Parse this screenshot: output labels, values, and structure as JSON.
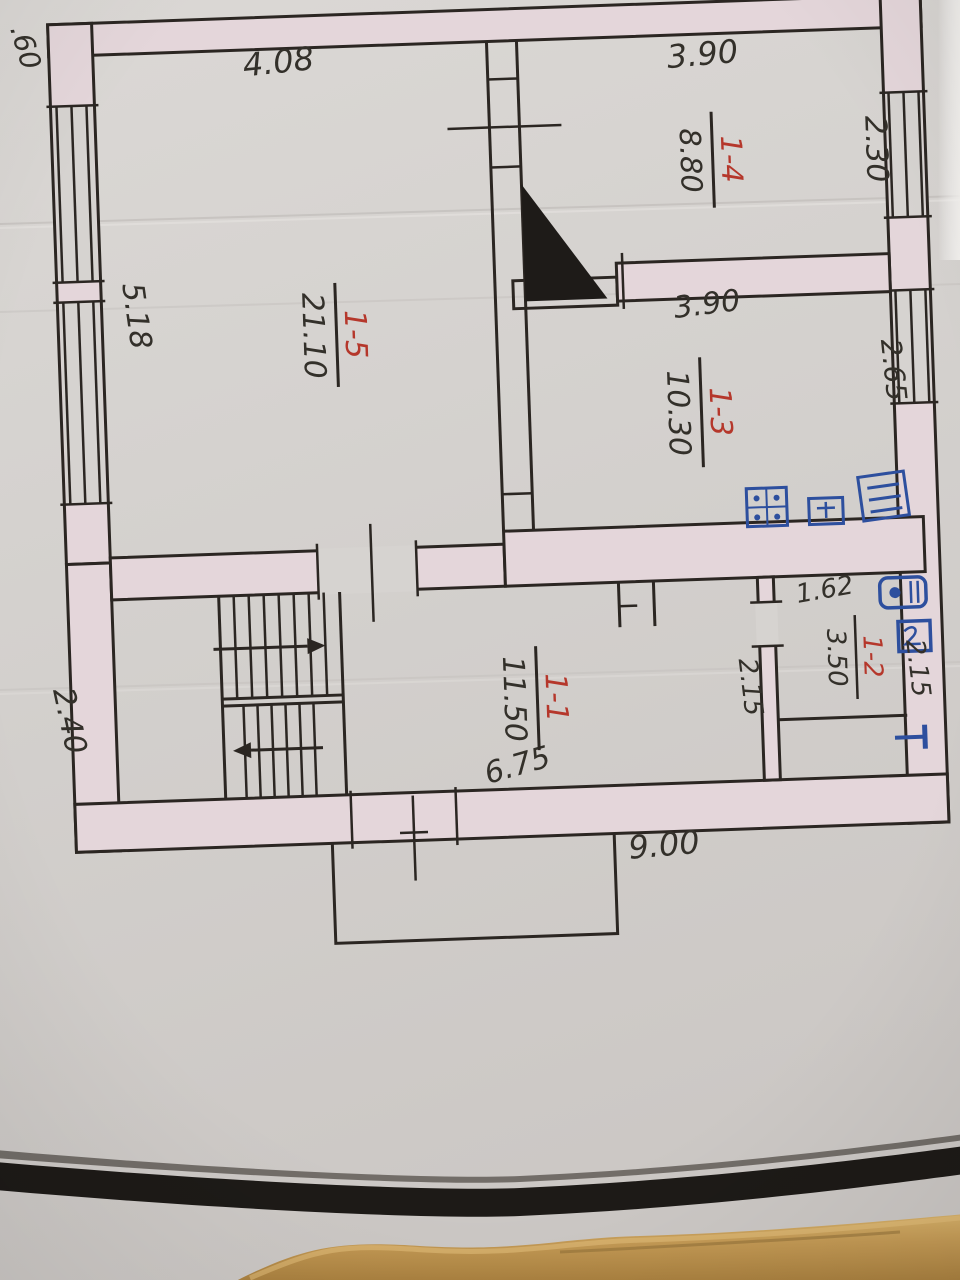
{
  "photo": {
    "paper_color": "#d6d3d0",
    "cardboard_color": "#c49a55",
    "band_color": "#1d1a17"
  },
  "plan": {
    "rooms": [
      {
        "number": "1-5",
        "area": "21.10"
      },
      {
        "number": "1-4",
        "area": "8.80"
      },
      {
        "number": "1-3",
        "area": "10.30"
      },
      {
        "number": "1-2",
        "area": "3.50"
      },
      {
        "number": "1-1",
        "area": "11.50"
      }
    ],
    "dimensions": {
      "corner_top_left": ".60",
      "top_left_width": "4.08",
      "top_right_width": "3.90",
      "right_upper": "2.30",
      "left_upper": "5.18",
      "kitchen_top_width": "3.90",
      "right_kitchen": "2.65",
      "bath_top_width": "1.62",
      "bath_left_height": "2.15",
      "bath_right_height": "2.15",
      "left_lower": "2.40",
      "hall_width": "6.75",
      "bottom_width": "9.00"
    },
    "fixtures": {
      "kitchen": [
        "gas-stove",
        "stand",
        "sink"
      ],
      "bathroom": [
        "boiler",
        "washbasin",
        "radiator"
      ]
    },
    "colors": {
      "ink": "#2b2622",
      "red_ink": "#b5372b",
      "blue_ink": "#2d4f9e",
      "wall_fill": "#e4d6da"
    }
  }
}
